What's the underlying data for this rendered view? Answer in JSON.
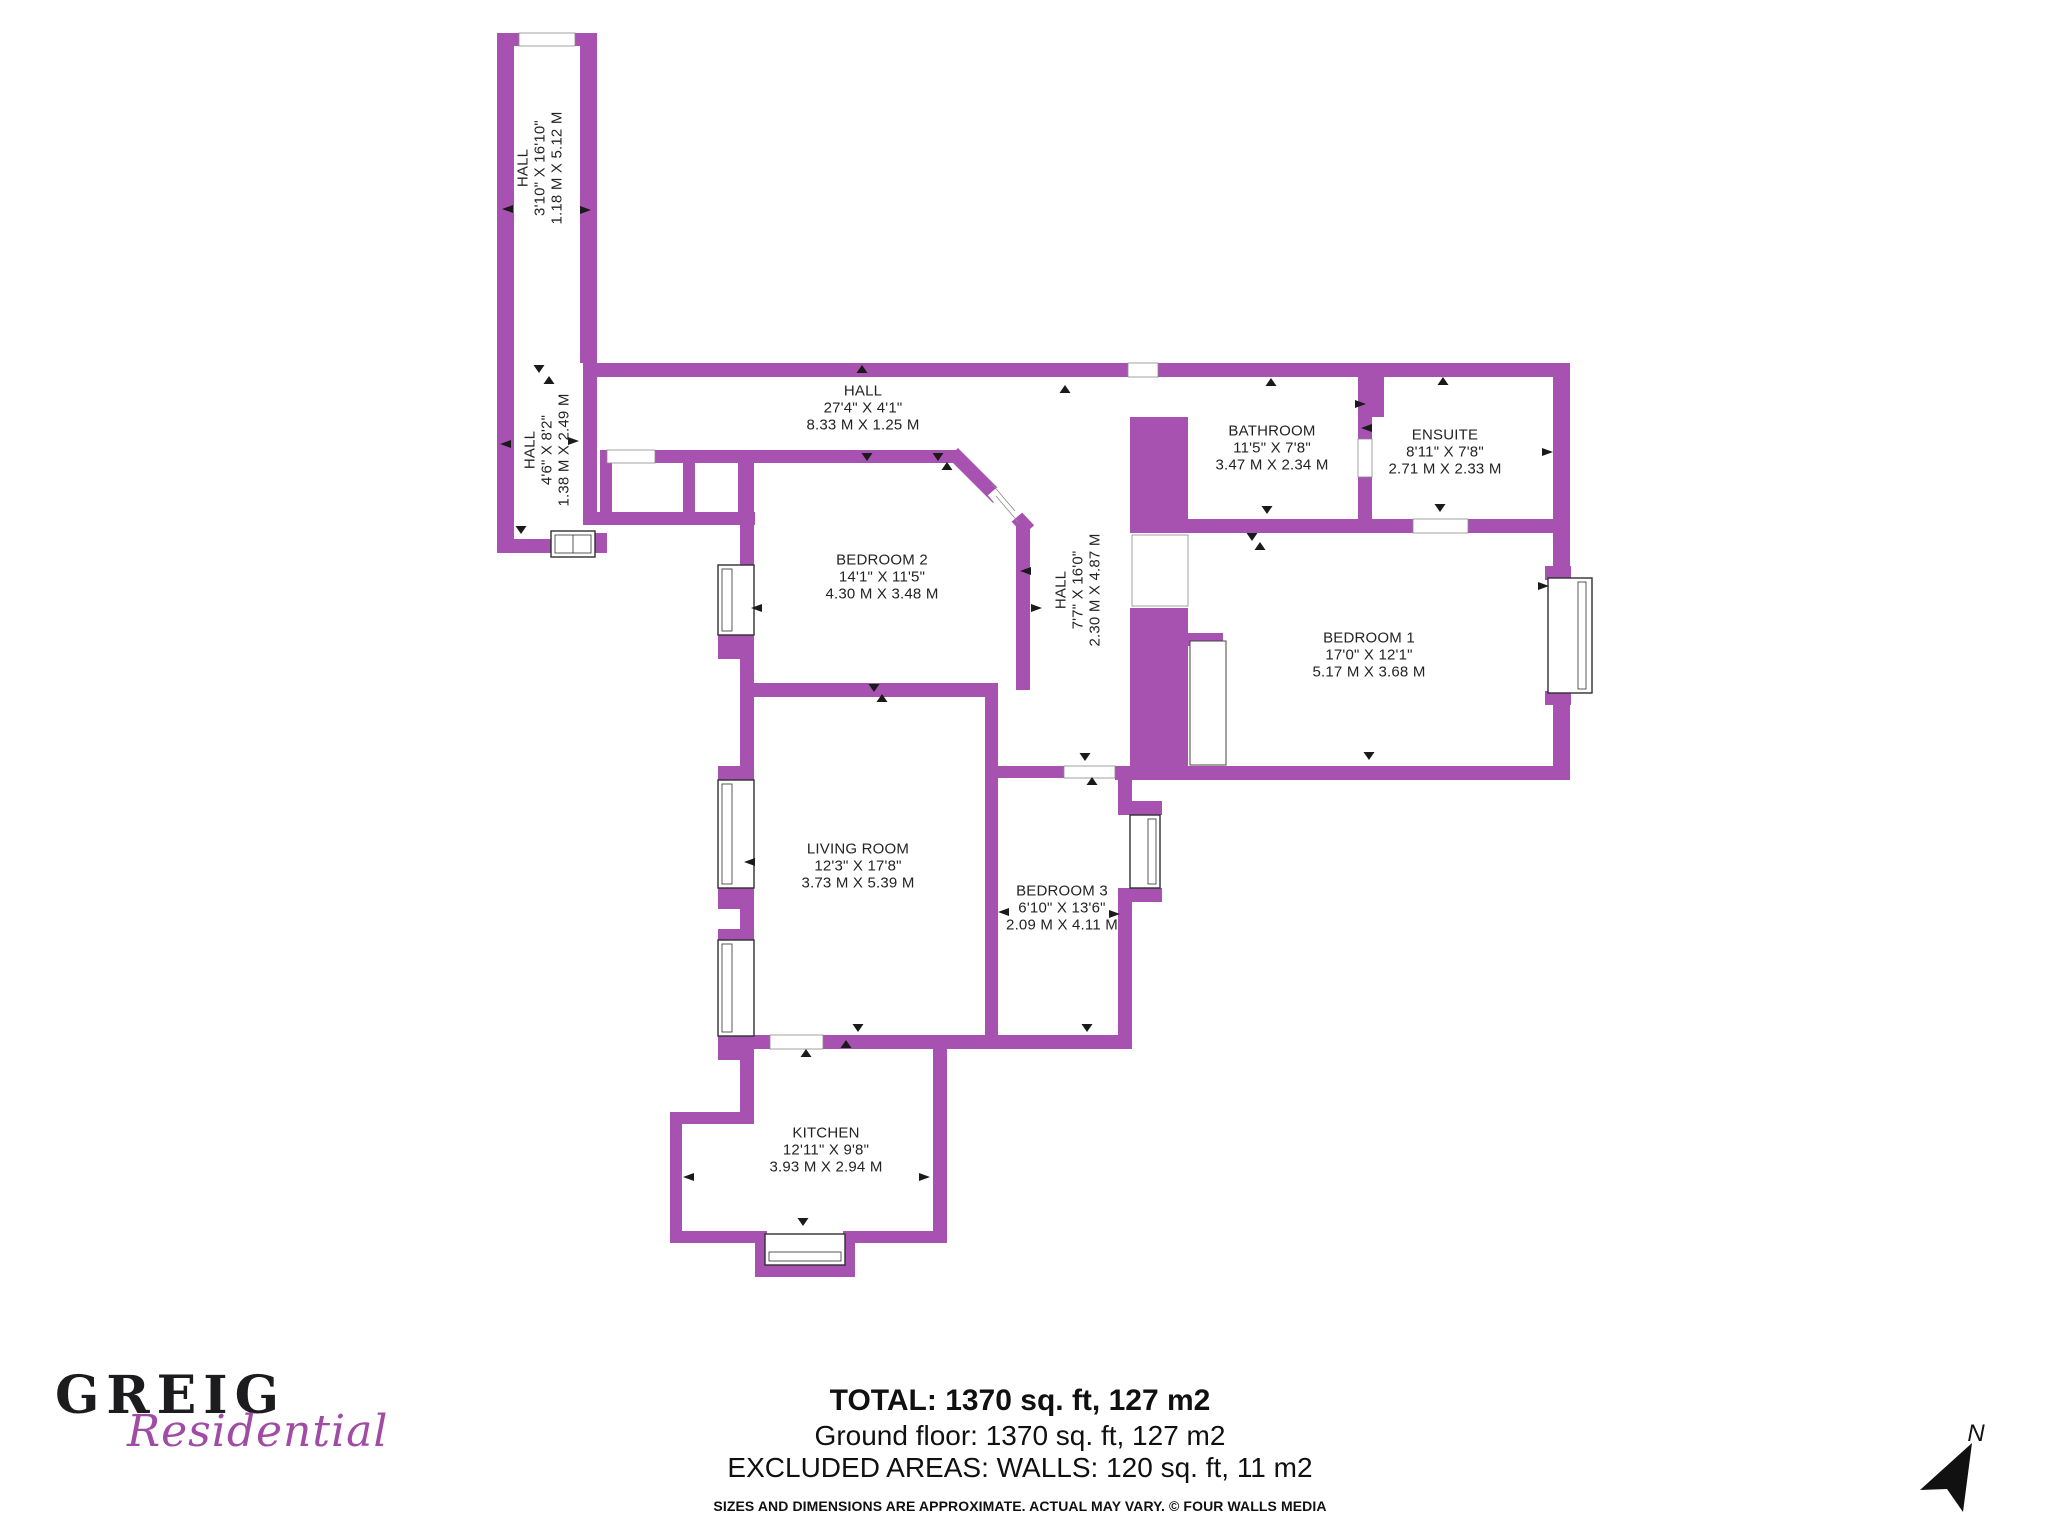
{
  "colors": {
    "wall": "#A752B0",
    "logo_secondary": "#A14CA4"
  },
  "floorplan": {
    "rooms": {
      "hall_top": {
        "name": "HALL",
        "imperial": "3'10\" X 16'10\"",
        "metric": "1.18 M X 5.12 M"
      },
      "hall_2": {
        "name": "HALL",
        "imperial": "4'6\" X 8'2\"",
        "metric": "1.38 M X 2.49 M"
      },
      "hall_main": {
        "name": "HALL",
        "imperial": "27'4\" X 4'1\"",
        "metric": "8.33 M X 1.25 M"
      },
      "hall_mid": {
        "name": "HALL",
        "imperial": "7'7\" X 16'0\"",
        "metric": "2.30 M X 4.87 M"
      },
      "bedroom2": {
        "name": "BEDROOM 2",
        "imperial": "14'1\" X 11'5\"",
        "metric": "4.30 M X 3.48 M"
      },
      "bathroom": {
        "name": "BATHROOM",
        "imperial": "11'5\" X 7'8\"",
        "metric": "3.47 M X 2.34 M"
      },
      "ensuite": {
        "name": "ENSUITE",
        "imperial": "8'11\" X 7'8\"",
        "metric": "2.71 M X 2.33 M"
      },
      "bedroom1": {
        "name": "BEDROOM 1",
        "imperial": "17'0\" X 12'1\"",
        "metric": "5.17 M X 3.68 M"
      },
      "living": {
        "name": "LIVING ROOM",
        "imperial": "12'3\" X 17'8\"",
        "metric": "3.73 M X 5.39 M"
      },
      "bedroom3": {
        "name": "BEDROOM 3",
        "imperial": "6'10\" X 13'6\"",
        "metric": "2.09 M X 4.11 M"
      },
      "kitchen": {
        "name": "KITCHEN",
        "imperial": "12'11\" X 9'8\"",
        "metric": "3.93 M X 2.94 M"
      }
    },
    "north_label": "N"
  },
  "footer": {
    "total": "TOTAL: 1370 sq. ft, 127 m2",
    "ground": "Ground floor: 1370 sq. ft, 127 m2",
    "excluded": "EXCLUDED AREAS: WALLS: 120 sq. ft, 11 m2",
    "disclaimer": "SIZES AND DIMENSIONS ARE APPROXIMATE. ACTUAL MAY VARY. © FOUR WALLS MEDIA"
  },
  "logo": {
    "primary": "GREIG",
    "secondary": "Residential"
  }
}
